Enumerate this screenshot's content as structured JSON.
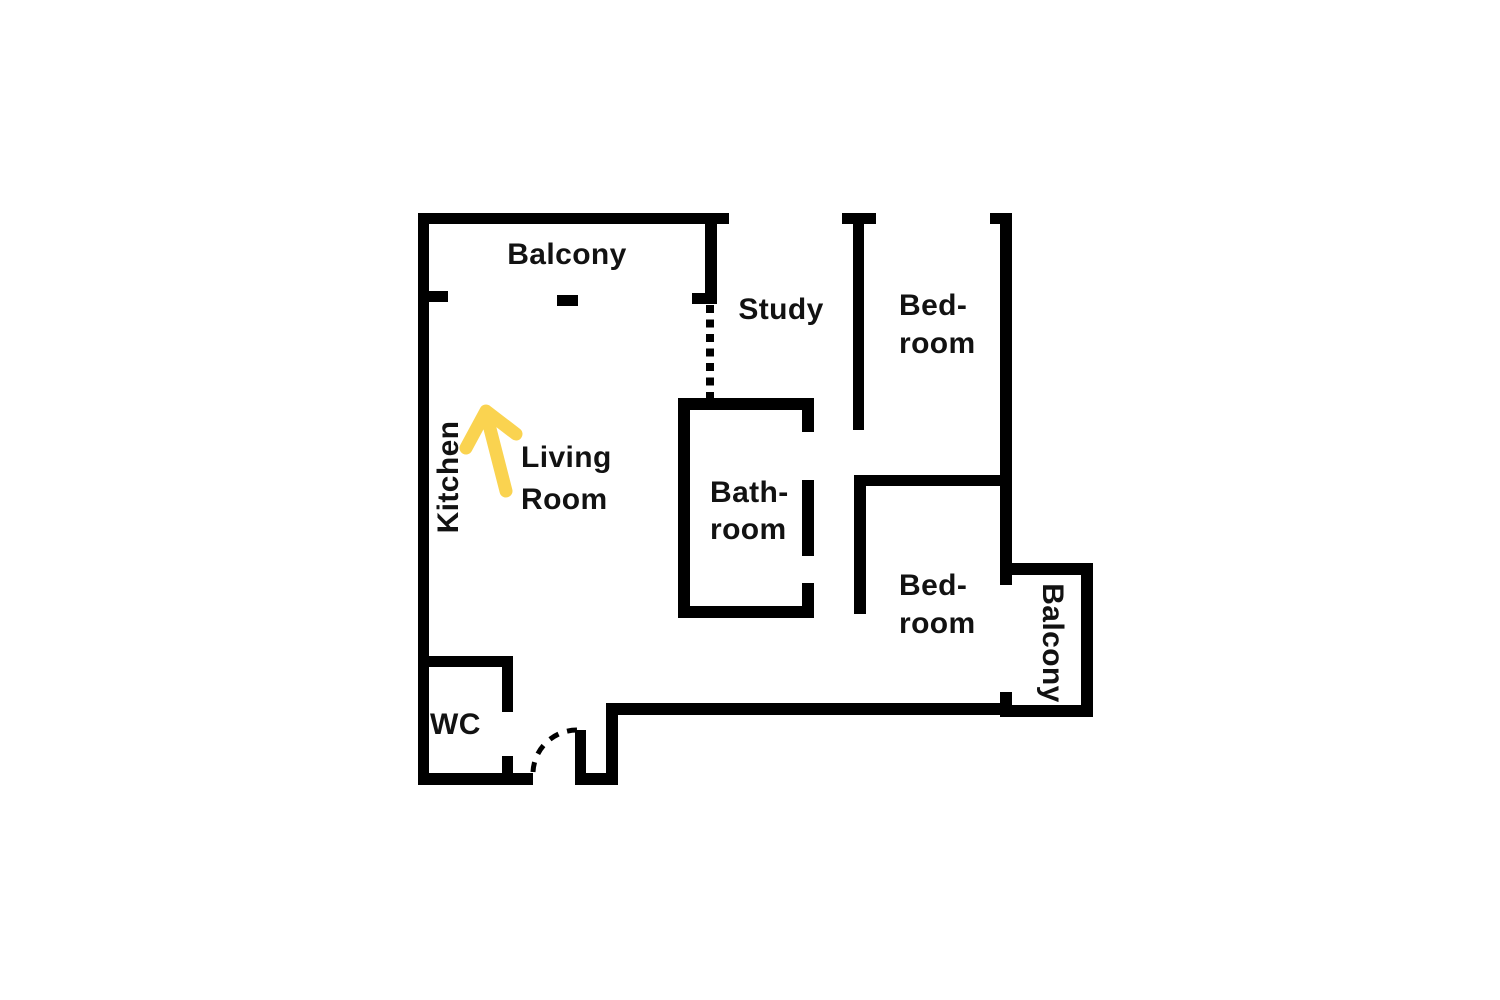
{
  "canvas": {
    "width": 1500,
    "height": 1000,
    "background": "#ffffff"
  },
  "palette": {
    "wall": "#000000",
    "label_text": "#121212",
    "arrow": "#FAD350"
  },
  "floorplan": {
    "rooms": [
      {
        "id": "balcony-top",
        "label": "Balcony"
      },
      {
        "id": "study",
        "label": "Study"
      },
      {
        "id": "bedroom-top",
        "label": "Bed-\nroom"
      },
      {
        "id": "kitchen",
        "label": "Kitchen"
      },
      {
        "id": "living-room",
        "label": "Living\nRoom"
      },
      {
        "id": "bathroom",
        "label": "Bath-\nroom"
      },
      {
        "id": "bedroom-bottom",
        "label": "Bed-\nroom"
      },
      {
        "id": "balcony-right",
        "label": "Balcony"
      },
      {
        "id": "wc",
        "label": "WC"
      }
    ],
    "annotations": [
      {
        "id": "direction-arrow",
        "icon": "up-arrow-icon",
        "color": "#FAD350"
      }
    ]
  }
}
